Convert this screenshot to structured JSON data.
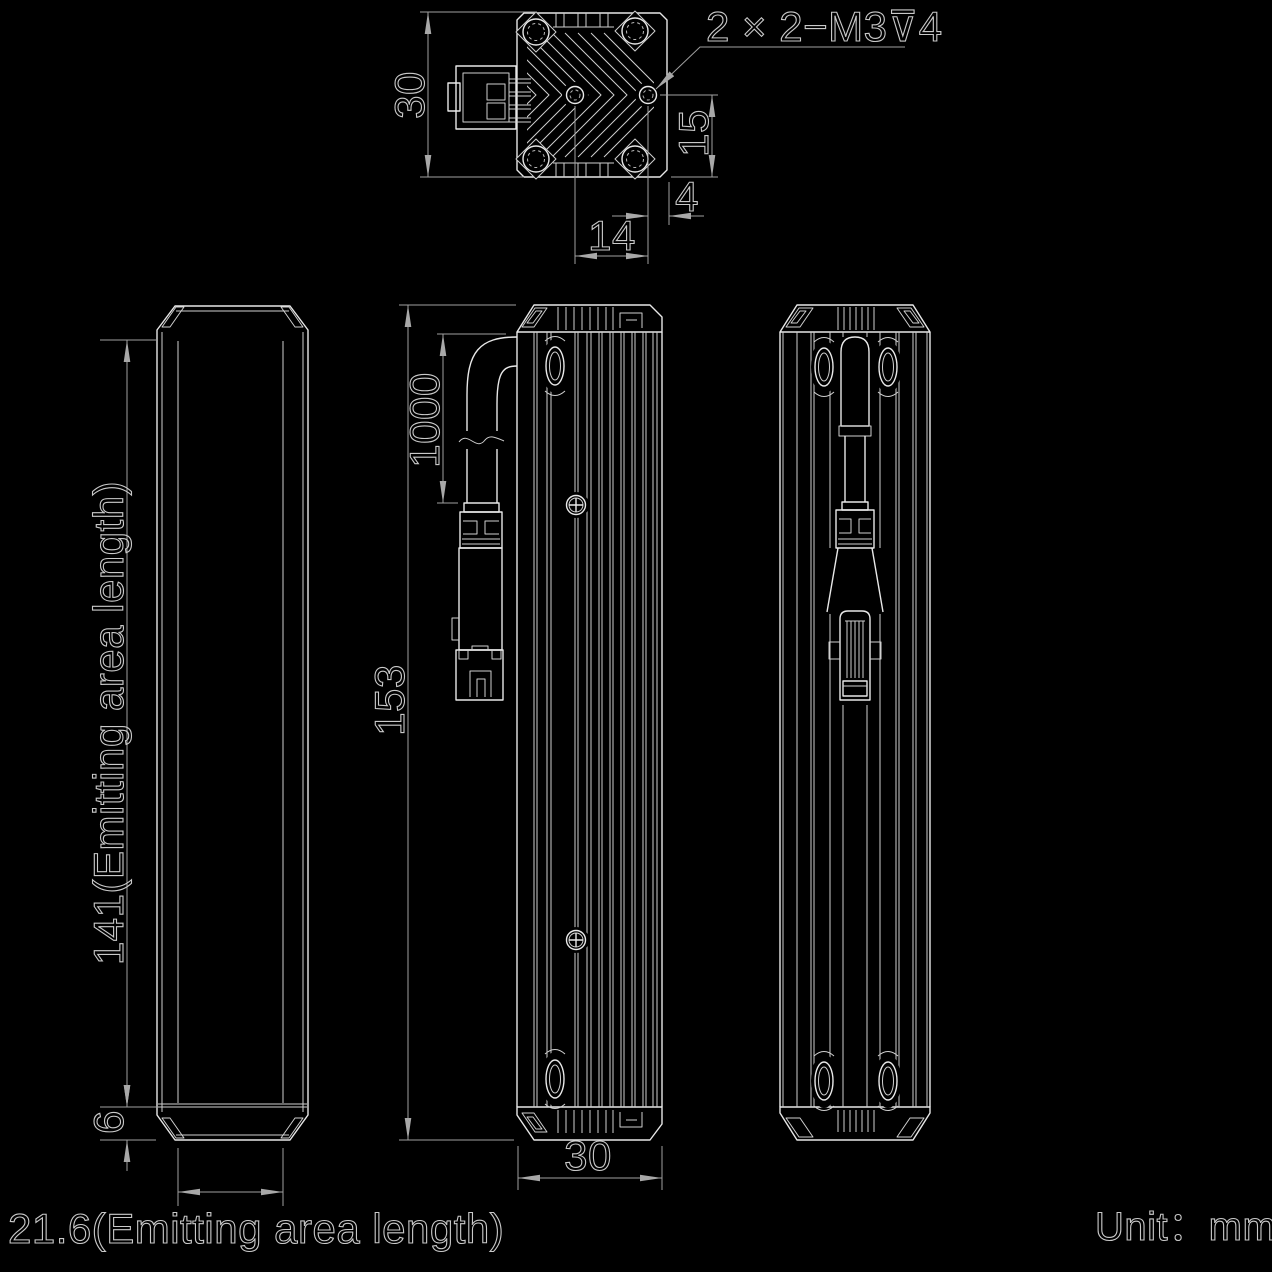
{
  "drawing": {
    "unit_note": "Unit：mm",
    "views": {
      "top": {
        "dim_height": "30",
        "dim_hole_offset": "15",
        "dim_edge_offset": "4",
        "dim_hole_spacing": "14",
        "thread_note": "2 × 2−M3⊽4"
      },
      "front": {
        "dim_emitting_length": "141(Emitting area length)",
        "dim_end_margin": "6",
        "dim_emitting_width": "21.6(Emitting area length)"
      },
      "side": {
        "dim_cable_length": "1000",
        "dim_body_length": "153",
        "dim_body_width": "30"
      }
    }
  }
}
